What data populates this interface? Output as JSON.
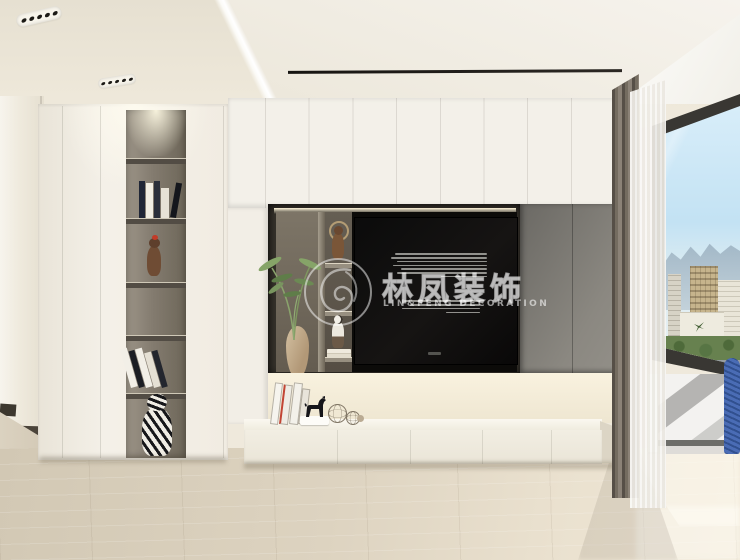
{
  "watermark": {
    "logo_icon": "phoenix-swirl-circle",
    "name_cn": "林凤装饰",
    "name_en": "LIN&FENG DECORATION"
  },
  "palette": {
    "ceiling_beige": "#ebe5d7",
    "cabinet_white": "#f3f0e9",
    "niche_brown_gray": "#6e665c",
    "cabinet_gray": "#7b7873",
    "backsplash_cream": "#f4edda",
    "floor_wood_light": "#ddd4c1",
    "tv_black": "#0a0a09",
    "curtain_gray_brown": "#6e675e",
    "sheer_white": "#f2f0ea",
    "sky_blue": "#c9e3f3",
    "foliage_green": "#7a9660",
    "accent_blue_figure": "#3f62ab"
  }
}
